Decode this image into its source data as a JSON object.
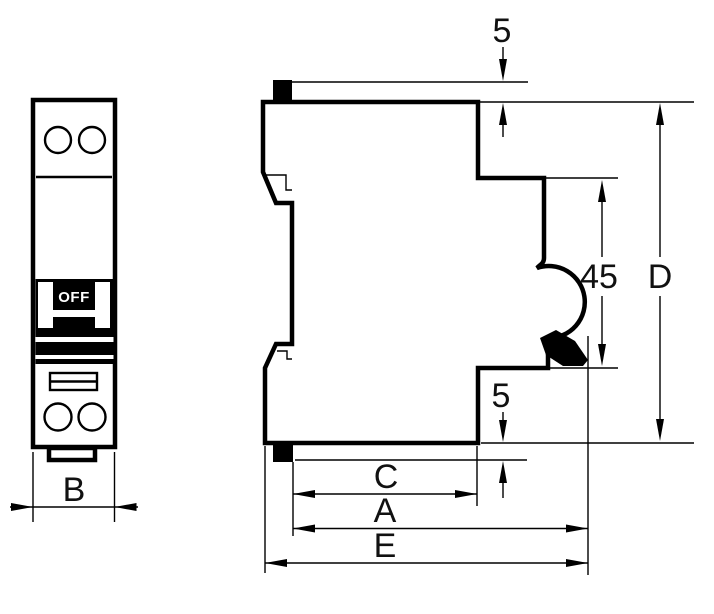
{
  "drawing": {
    "title": "circuit-breaker-dimensional-drawing",
    "colors": {
      "line": "#000000",
      "label": "#111111",
      "background": "#ffffff"
    },
    "front_view": {
      "toggle_label": "OFF",
      "dim_width": {
        "label": "B"
      }
    },
    "side_view": {
      "dim_top_clip_gap": {
        "label": "5"
      },
      "dim_notch_height": {
        "label": "45"
      },
      "dim_overall_height": {
        "label": "D"
      },
      "dim_bottom_clip_gap": {
        "label": "5"
      },
      "dim_pocket_depth": {
        "label": "C"
      },
      "dim_body_depth": {
        "label": "A"
      },
      "dim_overall_depth": {
        "label": "E"
      }
    }
  }
}
